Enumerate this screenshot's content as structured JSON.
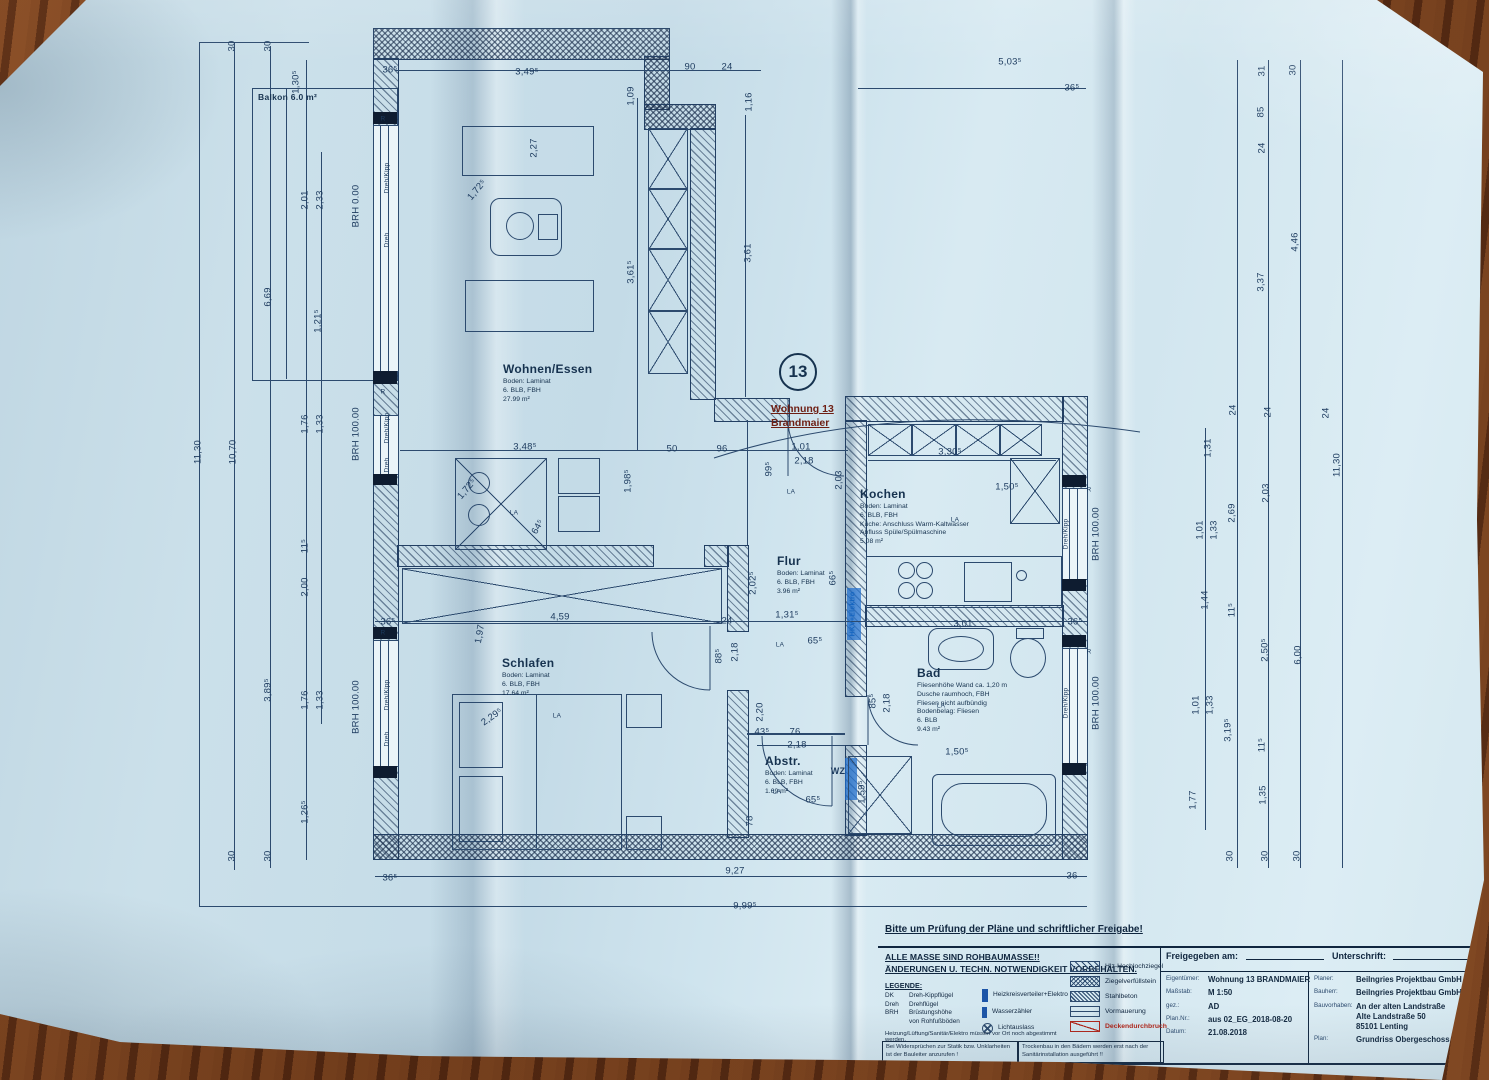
{
  "plan": {
    "unit_circle": "13",
    "unit_label": "Wohnung 13\nBrandmaier"
  },
  "rooms": [
    {
      "name": "Balkon 6.0 m²",
      "info": "",
      "x": 258,
      "y": 92,
      "f": "s"
    },
    {
      "name": "Wohnen/Essen",
      "info": "Boden: Laminat\n6. BLB, FBH\n27.99 m²",
      "x": 503,
      "y": 362
    },
    {
      "name": "Kochen",
      "info": "Boden: Laminat\n6. BLB, FBH\nKüche: Anschluss Warm-Kaltwasser\nAbfluss Spüle/Spülmaschine\n5.08 m²",
      "x": 860,
      "y": 487
    },
    {
      "name": "Flur",
      "info": "Boden: Laminat\n6. BLB, FBH\n3.96 m²",
      "x": 777,
      "y": 554
    },
    {
      "name": "Schlafen",
      "info": "Boden: Laminat\n6. BLB, FBH\n17.64 m²",
      "x": 502,
      "y": 656
    },
    {
      "name": "Bad",
      "info": "Fliesenhöhe Wand ca. 1,20 m\nDusche raumhoch, FBH\nFliesen nicht aufbündig\nBodenbelag: Fliesen\n6. BLB\n9.43 m²",
      "x": 917,
      "y": 666
    },
    {
      "name": "Abstr.",
      "info": "Boden: Laminat\n6. BLB, FBH\n1.69 m²",
      "x": 765,
      "y": 754
    }
  ],
  "dims": [
    {
      "t": "30",
      "x": 232,
      "y": 46,
      "r": -90
    },
    {
      "t": "30",
      "x": 268,
      "y": 46,
      "r": -90
    },
    {
      "t": "1,30⁵",
      "x": 296,
      "y": 82,
      "r": -90
    },
    {
      "t": "36⁵",
      "x": 390,
      "y": 70
    },
    {
      "t": "3,49⁵",
      "x": 527,
      "y": 72
    },
    {
      "t": "90",
      "x": 690,
      "y": 67
    },
    {
      "t": "24",
      "x": 727,
      "y": 67
    },
    {
      "t": "1,16",
      "x": 749,
      "y": 102,
      "r": -90
    },
    {
      "t": "1,09",
      "x": 631,
      "y": 96,
      "r": -90
    },
    {
      "t": "5,03⁵",
      "x": 1010,
      "y": 62
    },
    {
      "t": "36⁵",
      "x": 1072,
      "y": 88
    },
    {
      "t": "2,27",
      "x": 534,
      "y": 148,
      "r": -90
    },
    {
      "t": "3,61⁵",
      "x": 631,
      "y": 272,
      "r": -90
    },
    {
      "t": "3,61",
      "x": 748,
      "y": 253,
      "r": -90
    },
    {
      "t": "1,72⁵",
      "x": 477,
      "y": 190,
      "r": -50
    },
    {
      "t": "2,01",
      "x": 305,
      "y": 200,
      "r": -90
    },
    {
      "t": "2,33",
      "x": 320,
      "y": 200,
      "r": -90
    },
    {
      "t": "BRH 0.00",
      "x": 356,
      "y": 206,
      "r": -90
    },
    {
      "t": "6,69",
      "x": 268,
      "y": 297,
      "r": -90
    },
    {
      "t": "1,21⁵",
      "x": 318,
      "y": 321,
      "r": -90
    },
    {
      "t": "R",
      "x": 383,
      "y": 119,
      "f": "s"
    },
    {
      "t": "Dreh/Kipp",
      "x": 387,
      "y": 178,
      "r": -90,
      "f": "s"
    },
    {
      "t": "Dreh",
      "x": 387,
      "y": 240,
      "r": -90,
      "f": "s"
    },
    {
      "t": "11,30",
      "x": 198,
      "y": 452,
      "r": -90
    },
    {
      "t": "10,70",
      "x": 233,
      "y": 452,
      "r": -90
    },
    {
      "t": "1,76",
      "x": 305,
      "y": 424,
      "r": -90
    },
    {
      "t": "1,33",
      "x": 320,
      "y": 424,
      "r": -90
    },
    {
      "t": "BRH 100.00",
      "x": 356,
      "y": 434,
      "r": -90
    },
    {
      "t": "R",
      "x": 383,
      "y": 392,
      "f": "s"
    },
    {
      "t": "Dreh/Kipp",
      "x": 387,
      "y": 428,
      "r": -90,
      "f": "s"
    },
    {
      "t": "Dreh",
      "x": 387,
      "y": 465,
      "r": -90,
      "f": "s"
    },
    {
      "t": "3,48⁵",
      "x": 525,
      "y": 447
    },
    {
      "t": "50",
      "x": 672,
      "y": 449
    },
    {
      "t": "96",
      "x": 722,
      "y": 449
    },
    {
      "t": "1,01",
      "x": 801,
      "y": 447
    },
    {
      "t": "2,18",
      "x": 804,
      "y": 461
    },
    {
      "t": "99⁵",
      "x": 769,
      "y": 469,
      "r": -90
    },
    {
      "t": "2,03",
      "x": 839,
      "y": 480,
      "r": -90
    },
    {
      "t": "1,98⁵",
      "x": 628,
      "y": 481,
      "r": -90
    },
    {
      "t": "3,30⁵",
      "x": 950,
      "y": 452
    },
    {
      "t": "1,50⁵",
      "x": 1007,
      "y": 487
    },
    {
      "t": "LA",
      "x": 791,
      "y": 492,
      "f": "s"
    },
    {
      "t": "LA",
      "x": 955,
      "y": 520,
      "f": "s"
    },
    {
      "t": "LA",
      "x": 514,
      "y": 513,
      "f": "s"
    },
    {
      "t": "64⁵",
      "x": 538,
      "y": 527,
      "r": -60
    },
    {
      "t": "1,72⁵",
      "x": 467,
      "y": 489,
      "r": -50
    },
    {
      "t": "R",
      "x": 1089,
      "y": 490,
      "f": "s"
    },
    {
      "t": "Dreh/Kipp",
      "x": 1066,
      "y": 534,
      "r": -90,
      "f": "s"
    },
    {
      "t": "BRH 100.00",
      "x": 1096,
      "y": 534,
      "r": -90
    },
    {
      "t": "2,02⁵",
      "x": 753,
      "y": 583,
      "r": -90
    },
    {
      "t": "66⁵",
      "x": 833,
      "y": 578,
      "r": -90
    },
    {
      "t": "HKV+Elektro",
      "x": 853,
      "y": 614,
      "r": -90,
      "f": "sb"
    },
    {
      "t": "36⁵",
      "x": 388,
      "y": 622
    },
    {
      "t": "4,59",
      "x": 560,
      "y": 617
    },
    {
      "t": "1,97",
      "x": 480,
      "y": 634,
      "r": -80
    },
    {
      "t": "24",
      "x": 727,
      "y": 621
    },
    {
      "t": "1,31⁵",
      "x": 787,
      "y": 615
    },
    {
      "t": "65⁵",
      "x": 815,
      "y": 641
    },
    {
      "t": "LA",
      "x": 780,
      "y": 645,
      "f": "s"
    },
    {
      "t": "3,01",
      "x": 963,
      "y": 624
    },
    {
      "t": "36⁵",
      "x": 1075,
      "y": 622
    },
    {
      "t": "88⁵",
      "x": 719,
      "y": 656,
      "r": -90
    },
    {
      "t": "2,18",
      "x": 735,
      "y": 652,
      "r": -90
    },
    {
      "t": "11⁵",
      "x": 305,
      "y": 546,
      "r": -90
    },
    {
      "t": "2,00",
      "x": 305,
      "y": 587,
      "r": -90
    },
    {
      "t": "3,89⁵",
      "x": 268,
      "y": 690,
      "r": -90
    },
    {
      "t": "1,76",
      "x": 305,
      "y": 700,
      "r": -90
    },
    {
      "t": "1,33",
      "x": 320,
      "y": 700,
      "r": -90
    },
    {
      "t": "BRH 100.00",
      "x": 356,
      "y": 707,
      "r": -90
    },
    {
      "t": "R",
      "x": 383,
      "y": 633,
      "f": "s"
    },
    {
      "t": "Dreh/Kipp",
      "x": 387,
      "y": 695,
      "r": -90,
      "f": "s"
    },
    {
      "t": "Dreh",
      "x": 387,
      "y": 739,
      "r": -90,
      "f": "s"
    },
    {
      "t": "2,29⁵",
      "x": 492,
      "y": 717,
      "r": -35
    },
    {
      "t": "LA",
      "x": 557,
      "y": 716,
      "f": "s"
    },
    {
      "t": "1,26⁵",
      "x": 305,
      "y": 812,
      "r": -90
    },
    {
      "t": "30",
      "x": 232,
      "y": 856,
      "r": -90
    },
    {
      "t": "30",
      "x": 268,
      "y": 856,
      "r": -90
    },
    {
      "t": "2,20",
      "x": 760,
      "y": 712,
      "r": -90
    },
    {
      "t": "43⁵",
      "x": 762,
      "y": 732
    },
    {
      "t": "76",
      "x": 795,
      "y": 732
    },
    {
      "t": "2,18",
      "x": 797,
      "y": 745
    },
    {
      "t": "78",
      "x": 750,
      "y": 821,
      "r": -90
    },
    {
      "t": "WZ",
      "x": 838,
      "y": 771,
      "f": "w"
    },
    {
      "t": "65⁵",
      "x": 813,
      "y": 800
    },
    {
      "t": "LA",
      "x": 777,
      "y": 792,
      "f": "s"
    },
    {
      "t": "85⁵",
      "x": 873,
      "y": 701,
      "r": -90
    },
    {
      "t": "2,18",
      "x": 887,
      "y": 703,
      "r": -90
    },
    {
      "t": "1,59⁵",
      "x": 862,
      "y": 792,
      "r": -90
    },
    {
      "t": "1,50⁵",
      "x": 957,
      "y": 752
    },
    {
      "t": "LA",
      "x": 941,
      "y": 706,
      "f": "s"
    },
    {
      "t": "R",
      "x": 1089,
      "y": 652,
      "f": "s"
    },
    {
      "t": "Dreh/Kipp",
      "x": 1066,
      "y": 703,
      "r": -90,
      "f": "s"
    },
    {
      "t": "BRH 100.00",
      "x": 1096,
      "y": 703,
      "r": -90
    },
    {
      "t": "36⁵",
      "x": 390,
      "y": 878
    },
    {
      "t": "9,27",
      "x": 735,
      "y": 871
    },
    {
      "t": "36",
      "x": 1072,
      "y": 876
    },
    {
      "t": "9,99⁵",
      "x": 745,
      "y": 906
    },
    {
      "t": "31",
      "x": 1262,
      "y": 71,
      "r": -90
    },
    {
      "t": "30",
      "x": 1293,
      "y": 70,
      "r": -90
    },
    {
      "t": "85",
      "x": 1261,
      "y": 112,
      "r": -90
    },
    {
      "t": "24",
      "x": 1262,
      "y": 148,
      "r": -90
    },
    {
      "t": "4,46",
      "x": 1295,
      "y": 242,
      "r": -90
    },
    {
      "t": "3,37",
      "x": 1261,
      "y": 282,
      "r": -90
    },
    {
      "t": "24",
      "x": 1233,
      "y": 410,
      "r": -90
    },
    {
      "t": "24",
      "x": 1268,
      "y": 412,
      "r": -90
    },
    {
      "t": "24",
      "x": 1326,
      "y": 413,
      "r": -90
    },
    {
      "t": "1,31",
      "x": 1208,
      "y": 448,
      "r": -90
    },
    {
      "t": "11,30",
      "x": 1337,
      "y": 465,
      "r": -90
    },
    {
      "t": "2,03",
      "x": 1266,
      "y": 493,
      "r": -90
    },
    {
      "t": "2,69",
      "x": 1232,
      "y": 513,
      "r": -90
    },
    {
      "t": "1,01",
      "x": 1200,
      "y": 530,
      "r": -90
    },
    {
      "t": "1,33",
      "x": 1214,
      "y": 530,
      "r": -90
    },
    {
      "t": "1,44",
      "x": 1205,
      "y": 600,
      "r": -90
    },
    {
      "t": "11⁵",
      "x": 1232,
      "y": 610,
      "r": -90
    },
    {
      "t": "2,50⁵",
      "x": 1265,
      "y": 650,
      "r": -90
    },
    {
      "t": "6,00",
      "x": 1298,
      "y": 655,
      "r": -90
    },
    {
      "t": "1,01",
      "x": 1196,
      "y": 705,
      "r": -90
    },
    {
      "t": "1,33",
      "x": 1210,
      "y": 705,
      "r": -90
    },
    {
      "t": "3,19⁵",
      "x": 1228,
      "y": 730,
      "r": -90
    },
    {
      "t": "11⁵",
      "x": 1262,
      "y": 745,
      "r": -90
    },
    {
      "t": "1,77",
      "x": 1193,
      "y": 800,
      "r": -90
    },
    {
      "t": "1,35",
      "x": 1263,
      "y": 795,
      "r": -90
    },
    {
      "t": "30",
      "x": 1230,
      "y": 856,
      "r": -90
    },
    {
      "t": "30",
      "x": 1265,
      "y": 856,
      "r": -90
    },
    {
      "t": "30",
      "x": 1297,
      "y": 856,
      "r": -90
    }
  ],
  "notes": {
    "review": "Bitte um Prüfung der Pläne und schriftlicher Freigabe!",
    "masse": "ALLE MASSE SIND ROHBAUMASSE!!\nÄNDERUNGEN U. TECHN. NOTWENDIGKEIT VORBEHALTEN.",
    "heizung": "Heizung/Lüftung/Sanitär/Elektro müssen vor Ort noch abgestimmt werden.",
    "statik": "Bei Widersprüchen zur Statik bzw. Unklarheiten ist der Bauleiter anzurufen !",
    "trockenbau": "Trockenbau in den Bädern werden erst nach der Sanitärinstallation ausgeführt !!"
  },
  "legend": {
    "title": "LEGENDE:",
    "abbr": [
      {
        "k": "DK",
        "v": "Dreh-Kippflügel"
      },
      {
        "k": "Dreh",
        "v": "Drehflügel"
      },
      {
        "k": "BRH",
        "v": "Brüstungshöhe\nvon Rohfußböden"
      }
    ],
    "symbols": [
      {
        "k": "HKV",
        "v": "Heizkreisverteiler+Elektro"
      },
      {
        "k": "WZ",
        "v": "Wasserzähler"
      },
      {
        "k": "LA",
        "v": "Lichtauslass"
      }
    ],
    "hatches": [
      {
        "v": "Hlz-Hochlochziegel",
        "style": "h1",
        "red": false
      },
      {
        "v": "Ziegelverfüllstein",
        "style": "h2",
        "red": false
      },
      {
        "v": "Stahlbeton",
        "style": "h3",
        "red": false
      },
      {
        "v": "Vormauerung",
        "style": "h4",
        "red": false
      },
      {
        "v": "Deckendurchbruch",
        "style": "h5",
        "red": true
      }
    ]
  },
  "titleblock": {
    "freigegeben_label": "Freigegeben am:",
    "unterschrift_label": "Unterschrift:",
    "rows": [
      {
        "k": "Eigentümer:",
        "v": "Wohnung 13 BRANDMAIER"
      },
      {
        "k": "Maßstab:",
        "v": "M 1:50"
      },
      {
        "k": "gez.:",
        "v": "AD"
      },
      {
        "k": "Plan.Nr.:",
        "v": "aus 02_EG_2018-08-20"
      },
      {
        "k": "Datum:",
        "v": "21.08.2018"
      }
    ],
    "rows2": [
      {
        "k": "Planer:",
        "v": "Beilngries Projektbau GmbH"
      },
      {
        "k": "Bauherr:",
        "v": "Beilngries Projektbau GmbH"
      },
      {
        "k": "Bauvorhaben:",
        "v": "An der alten Landstraße\nAlte Landstraße 50\n85101 Lenting"
      },
      {
        "k": "Plan:",
        "v": "Grundriss Obergeschoss"
      }
    ]
  },
  "colors": {
    "ink": "#2c4a6e",
    "red": "#b02418",
    "blue": "#1c55a8",
    "paper": "#cfe4ee",
    "wood": "#6d3a1c"
  }
}
